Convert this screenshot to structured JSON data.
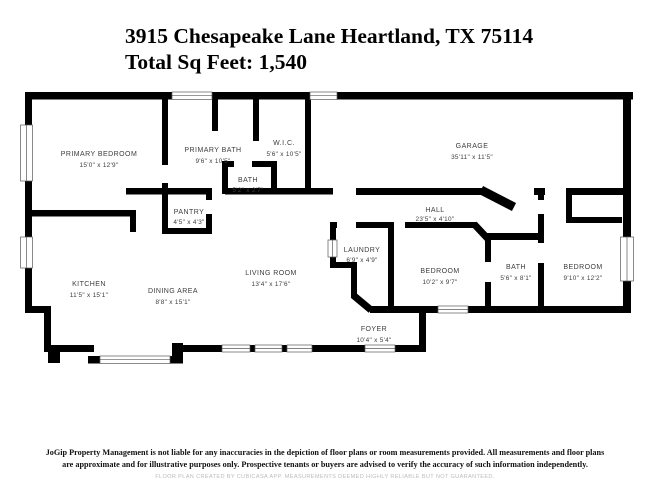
{
  "header": {
    "address": "3915 Chesapeake Lane Heartland, TX 75114",
    "total_sq_feet": "Total Sq Feet: 1,540"
  },
  "rooms": [
    {
      "name": "PRIMARY BEDROOM",
      "dims": "15'0\" x 12'9\""
    },
    {
      "name": "PRIMARY BATH",
      "dims": "9'6\" x 10'5\""
    },
    {
      "name": "W.I.C.",
      "dims": "5'6\" x 10'5\""
    },
    {
      "name": "BATH",
      "dims": "5'2\" x 2'7\""
    },
    {
      "name": "PANTRY",
      "dims": "4'5\" x 4'3\""
    },
    {
      "name": "GARAGE",
      "dims": "35'11\" x 11'5\""
    },
    {
      "name": "HALL",
      "dims": "23'5\" x 4'10\""
    },
    {
      "name": "LAUNDRY",
      "dims": "6'9\" x 4'9\""
    },
    {
      "name": "BEDROOM",
      "dims": "10'2\" x 9'7\""
    },
    {
      "name": "BATH",
      "dims": "5'6\" x 8'1\""
    },
    {
      "name": "BEDROOM",
      "dims": "9'10\" x 12'2\""
    },
    {
      "name": "KITCHEN",
      "dims": "11'5\" x 15'1\""
    },
    {
      "name": "DINING AREA",
      "dims": "8'8\" x 15'1\""
    },
    {
      "name": "LIVING ROOM",
      "dims": "13'4\" x 17'6\""
    },
    {
      "name": "FOYER",
      "dims": "10'4\" x 5'4\""
    }
  ],
  "footer": {
    "disclaimer_line1": "JoGip Property Management is not liable for any inaccuracies in the depiction of floor plans or room measurements provided. All measurements and floor plans",
    "disclaimer_line2": "are approximate and for illustrative purposes only. Prospective tenants or buyers are advised to verify the accuracy of such information independently.",
    "credit": "FLOOR PLAN CREATED BY CUBICASA APP. MEASUREMENTS DEEMED HIGHLY RELIABLE BUT NOT GUARANTEED."
  },
  "colors": {
    "wall": "#000000",
    "label": "#3d3d3d",
    "credit": "#bcbcbc"
  }
}
